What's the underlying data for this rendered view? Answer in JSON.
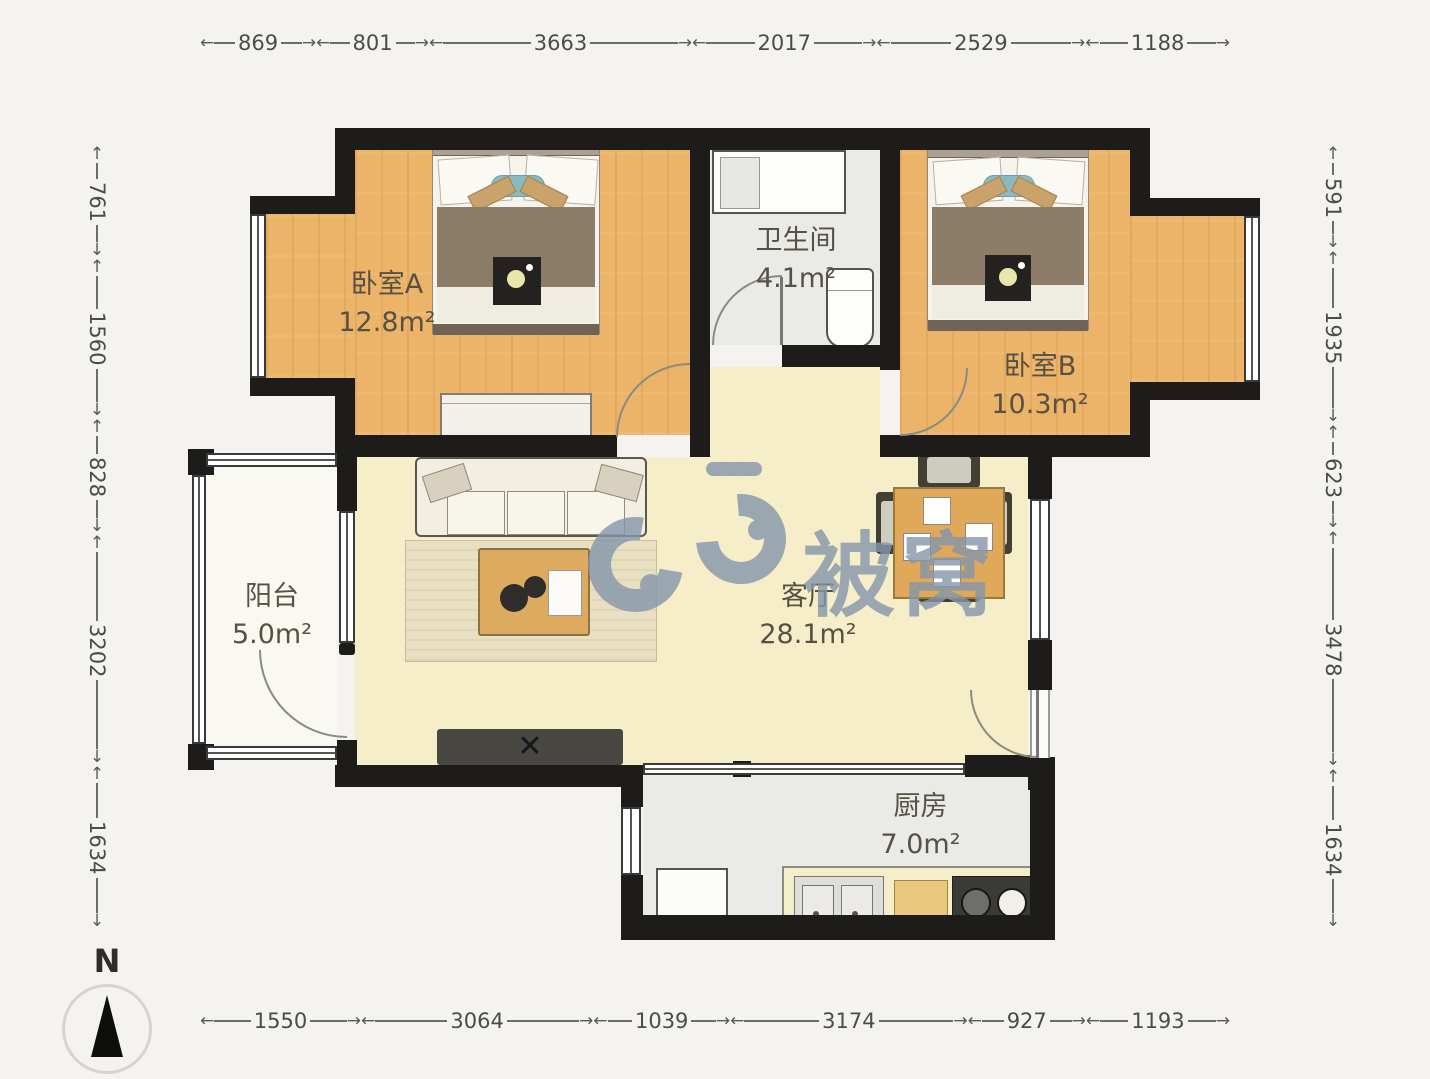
{
  "dimensions": {
    "top": [
      "869",
      "801",
      "3663",
      "2017",
      "2529",
      "1188"
    ],
    "bottom": [
      "1550",
      "3064",
      "1039",
      "3174",
      "927",
      "1193"
    ],
    "left": [
      "761",
      "1560",
      "828",
      "3202",
      "1634"
    ],
    "right": [
      "591",
      "1935",
      "623",
      "3478",
      "1634"
    ]
  },
  "rooms": {
    "bedroomA": {
      "name": "卧室A",
      "area": "12.8m²"
    },
    "bathroom": {
      "name": "卫生间",
      "area": "4.1m²"
    },
    "bedroomB": {
      "name": "卧室B",
      "area": "10.3m²"
    },
    "living": {
      "name": "客厅",
      "area": "28.1m²"
    },
    "balcony": {
      "name": "阳台",
      "area": "5.0m²"
    },
    "kitchen": {
      "name": "厨房",
      "area": "7.0m²"
    }
  },
  "watermark": {
    "text": "被窝",
    "logo_color": "#8496ab"
  },
  "compass": {
    "label": "N"
  },
  "colors": {
    "wall": "#1d1c1a",
    "wood_floor": "#ecb468",
    "living_floor": "#f6eec9",
    "tile_floor": "#eaeae7",
    "balcony_floor": "#faf9f1"
  }
}
